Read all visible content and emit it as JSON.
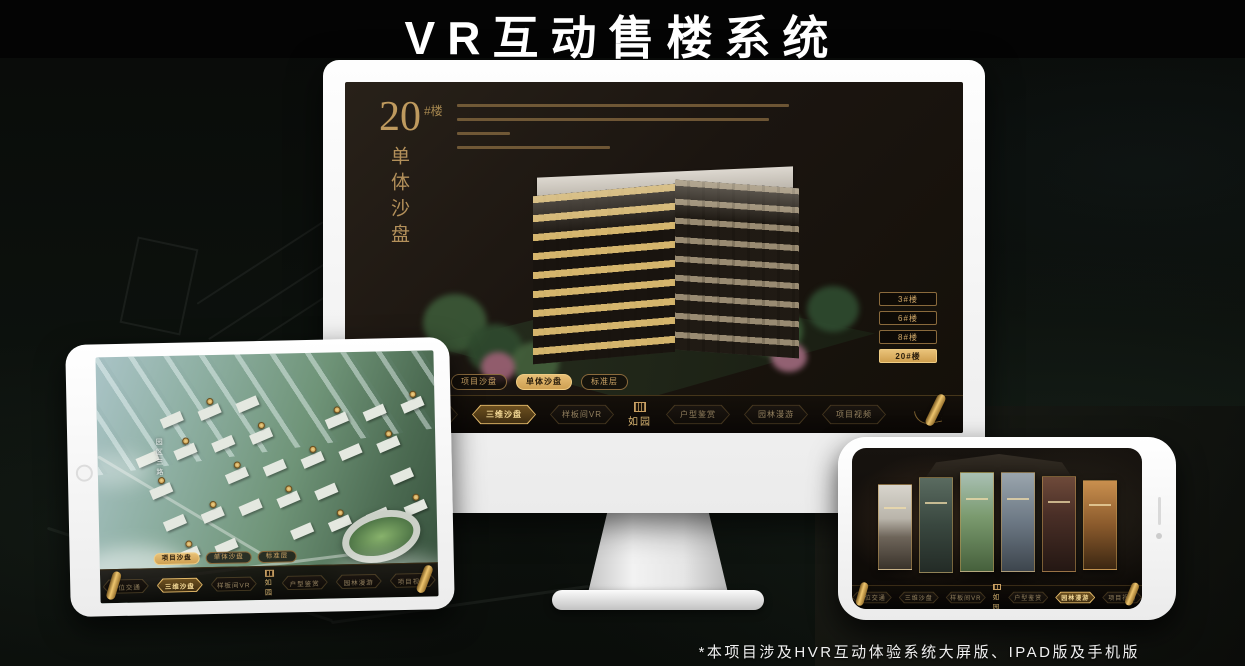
{
  "page": {
    "title": "VR互动售楼系统",
    "footnote": "*本项目涉及HVR互动体验系统大屏版、IPAD版及手机版"
  },
  "colors": {
    "gold": "#c9a063",
    "gold_bright": "#e8c26a",
    "screen_bg": "#1a140f",
    "nav_bg": "#0c0906",
    "aerial_green": "#6f9478"
  },
  "icons": {
    "scroll": "scroll-icon",
    "seal": "seal-icon",
    "home": "home-button",
    "speaker": "speaker-slit",
    "camera": "camera-dot"
  },
  "monitor": {
    "heading": {
      "number": "20",
      "suffix": "#楼",
      "vertical": "单体沙盘"
    },
    "paragraph": {
      "lines": 4,
      "note": "small gold descriptive text (illegible in source)"
    },
    "floor_buttons": [
      {
        "label": "3#楼",
        "active": false
      },
      {
        "label": "6#楼",
        "active": false
      },
      {
        "label": "8#楼",
        "active": false
      },
      {
        "label": "20#楼",
        "active": true
      }
    ],
    "sub_tabs": [
      {
        "label": "项目沙盘",
        "active": false
      },
      {
        "label": "单体沙盘",
        "active": true
      },
      {
        "label": "标准层",
        "active": false
      }
    ],
    "nav": {
      "left": [
        {
          "label": "区位交通",
          "active": false
        },
        {
          "label": "三维沙盘",
          "active": true
        },
        {
          "label": "样板间VR",
          "active": false
        }
      ],
      "logo": "如园",
      "right": [
        {
          "label": "户型鉴赏",
          "active": false
        },
        {
          "label": "园林漫游",
          "active": false
        },
        {
          "label": "项目视频",
          "active": false
        }
      ]
    }
  },
  "tablet": {
    "road_label": "园区三路",
    "marker_count": 22,
    "sub_tabs": [
      {
        "label": "项目沙盘",
        "active": true
      },
      {
        "label": "单体沙盘",
        "active": false
      },
      {
        "label": "标准层",
        "active": false
      }
    ],
    "nav": {
      "left": [
        {
          "label": "区位交通",
          "active": false
        },
        {
          "label": "三维沙盘",
          "active": true
        },
        {
          "label": "样板间VR",
          "active": false
        }
      ],
      "logo": "如园",
      "right": [
        {
          "label": "户型鉴赏",
          "active": false
        },
        {
          "label": "园林漫游",
          "active": false
        },
        {
          "label": "项目视频",
          "active": false
        }
      ]
    }
  },
  "phone": {
    "gallery_panels": 6,
    "nav": {
      "left": [
        {
          "label": "区位交通",
          "active": false
        },
        {
          "label": "三维沙盘",
          "active": false
        },
        {
          "label": "样板间VR",
          "active": false
        }
      ],
      "logo": "如园",
      "right": [
        {
          "label": "户型鉴赏",
          "active": false
        },
        {
          "label": "园林漫游",
          "active": true
        },
        {
          "label": "项目视频",
          "active": false
        }
      ]
    }
  }
}
